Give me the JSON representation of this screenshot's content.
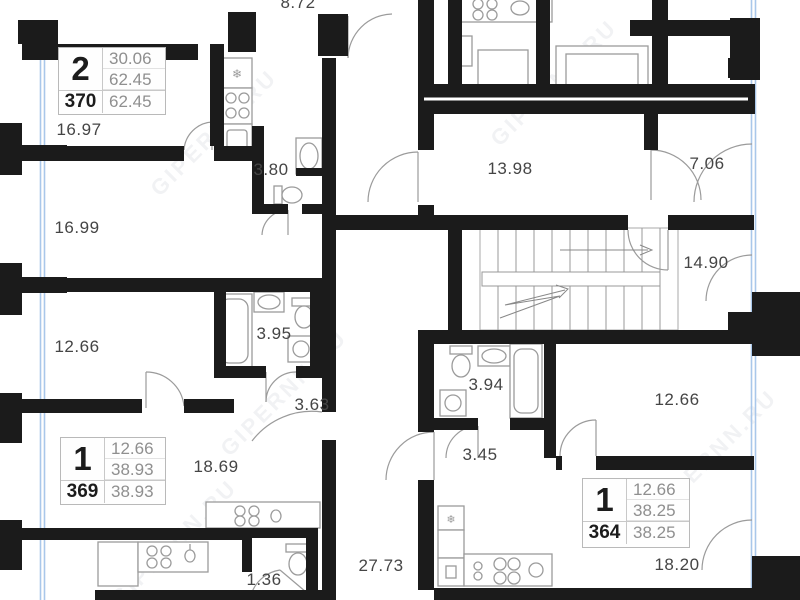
{
  "watermark": {
    "text": "GIPERNN.RU"
  },
  "colors": {
    "wall": "#1b1b1b",
    "window_glass": "#a9c7ea",
    "fixture": "#9b9b9b",
    "label_text": "#454545"
  },
  "icons": {
    "fridge_glyph": "❄"
  },
  "apartments": [
    {
      "type": "2",
      "number": "370",
      "living_area": "30.06",
      "area": "62.45",
      "total_area": "62.45"
    },
    {
      "type": "1",
      "number": "369",
      "living_area": "12.66",
      "area": "38.93",
      "total_area": "38.93"
    },
    {
      "type": "1",
      "number": "364",
      "living_area": "12.66",
      "area": "38.25",
      "total_area": "38.25"
    }
  ],
  "room_labels": [
    {
      "room": "top-room-partial",
      "value": "8.72"
    },
    {
      "room": "bedroom-370-a",
      "value": "16.97"
    },
    {
      "room": "bedroom-370-b",
      "value": "16.99"
    },
    {
      "room": "bedroom-369",
      "value": "12.66"
    },
    {
      "room": "bathroom-370",
      "value": "3.80"
    },
    {
      "room": "bathroom-369",
      "value": "3.95"
    },
    {
      "room": "hall-369",
      "value": "3.63"
    },
    {
      "room": "living-369",
      "value": "18.69"
    },
    {
      "room": "wc-bottom",
      "value": "1.36"
    },
    {
      "room": "corridor-vertical",
      "value": "27.73"
    },
    {
      "room": "corridor-common",
      "value": "13.98"
    },
    {
      "room": "lobby",
      "value": "7.06"
    },
    {
      "room": "stair-hall",
      "value": "14.90"
    },
    {
      "room": "bathroom-364",
      "value": "3.94"
    },
    {
      "room": "hall-364",
      "value": "3.45"
    },
    {
      "room": "bedroom-364",
      "value": "12.66"
    },
    {
      "room": "living-364",
      "value": "18.20"
    }
  ]
}
